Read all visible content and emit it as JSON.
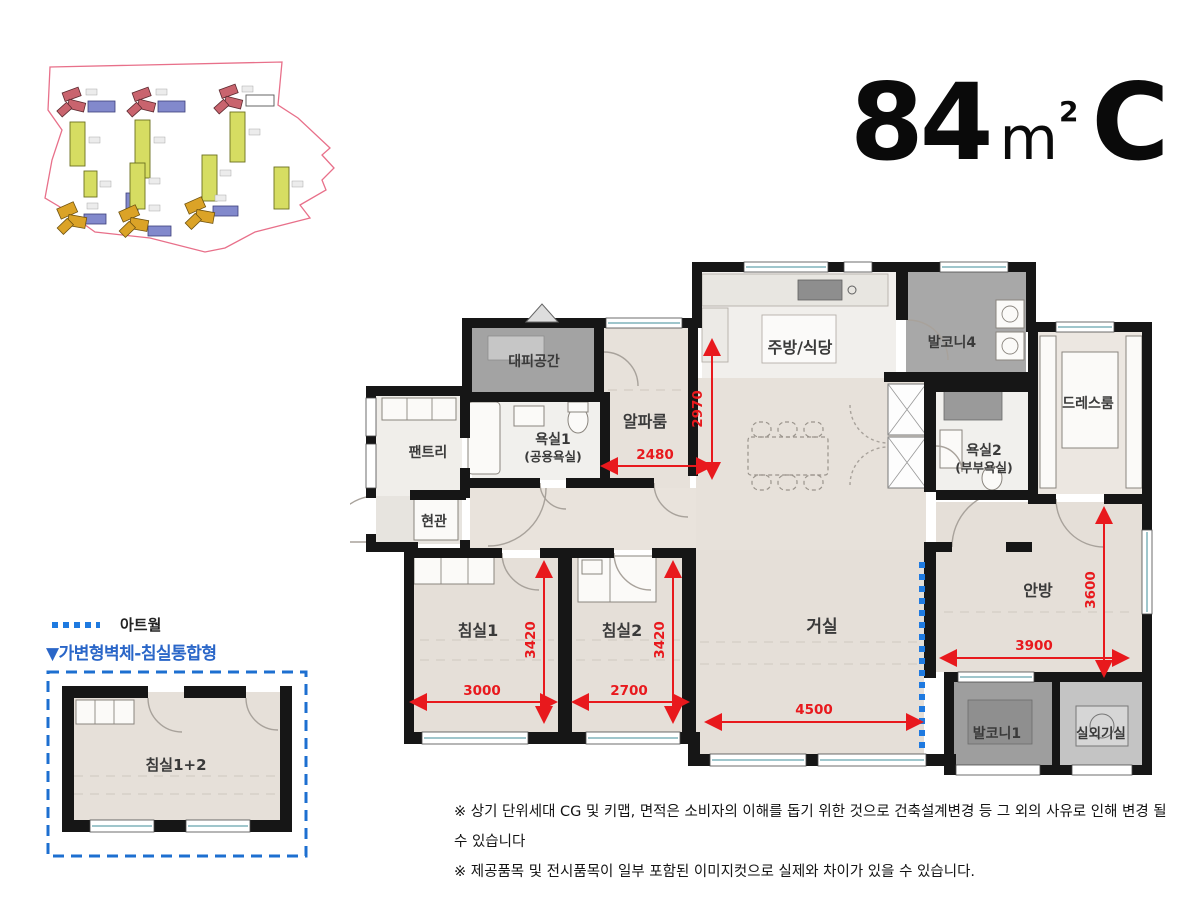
{
  "title": {
    "area": "84",
    "unit": "m",
    "sup": "2",
    "type": "C"
  },
  "rooms": {
    "evac": {
      "label": "대피공간"
    },
    "alpha": {
      "label": "알파룸"
    },
    "kitchen": {
      "label": "주방/식당"
    },
    "balcony4": {
      "label": "발코니4"
    },
    "dress": {
      "label": "드레스룸"
    },
    "pantry": {
      "label": "팬트리"
    },
    "bath1": {
      "label": "욕실1",
      "sub": "(공용욕실)"
    },
    "bath2": {
      "label": "욕실2",
      "sub": "(부부욕실)"
    },
    "entrance": {
      "label": "현관"
    },
    "bed1": {
      "label": "침실1"
    },
    "bed2": {
      "label": "침실2"
    },
    "living": {
      "label": "거실"
    },
    "master": {
      "label": "안방"
    },
    "balcony1": {
      "label": "발코니1"
    },
    "outdoor": {
      "label": "실외기실"
    }
  },
  "dimensions": {
    "alpha_h": "2970",
    "alpha_w": "2480",
    "bed1_h": "3420",
    "bed1_w": "3000",
    "bed2_h": "3420",
    "bed2_w": "2700",
    "living_w": "4500",
    "master_w": "3900",
    "master_h": "3600"
  },
  "legend": {
    "artwall": "아트월",
    "variant": "▼가변형벽체-침실통합형",
    "merged": "침실1+2"
  },
  "notes": [
    "※ 상기 단위세대 CG 및 키맵, 면적은 소비자의 이해를 돕기 위한 것으로 건축설계변경 등 그 외의 사유로 인해 변경 될 수 있습니다",
    "※ 제공품목 및 전시품목이 일부 포함된 이미지컷으로 실제와 차이가 있을 수 있습니다."
  ],
  "colors": {
    "dimension_red": "#e8191d",
    "artwall_blue": "#1f7ae0",
    "variant_blue": "#2a66c8",
    "wall_black": "#161616",
    "site_boundary_pink": "#e8708a"
  }
}
